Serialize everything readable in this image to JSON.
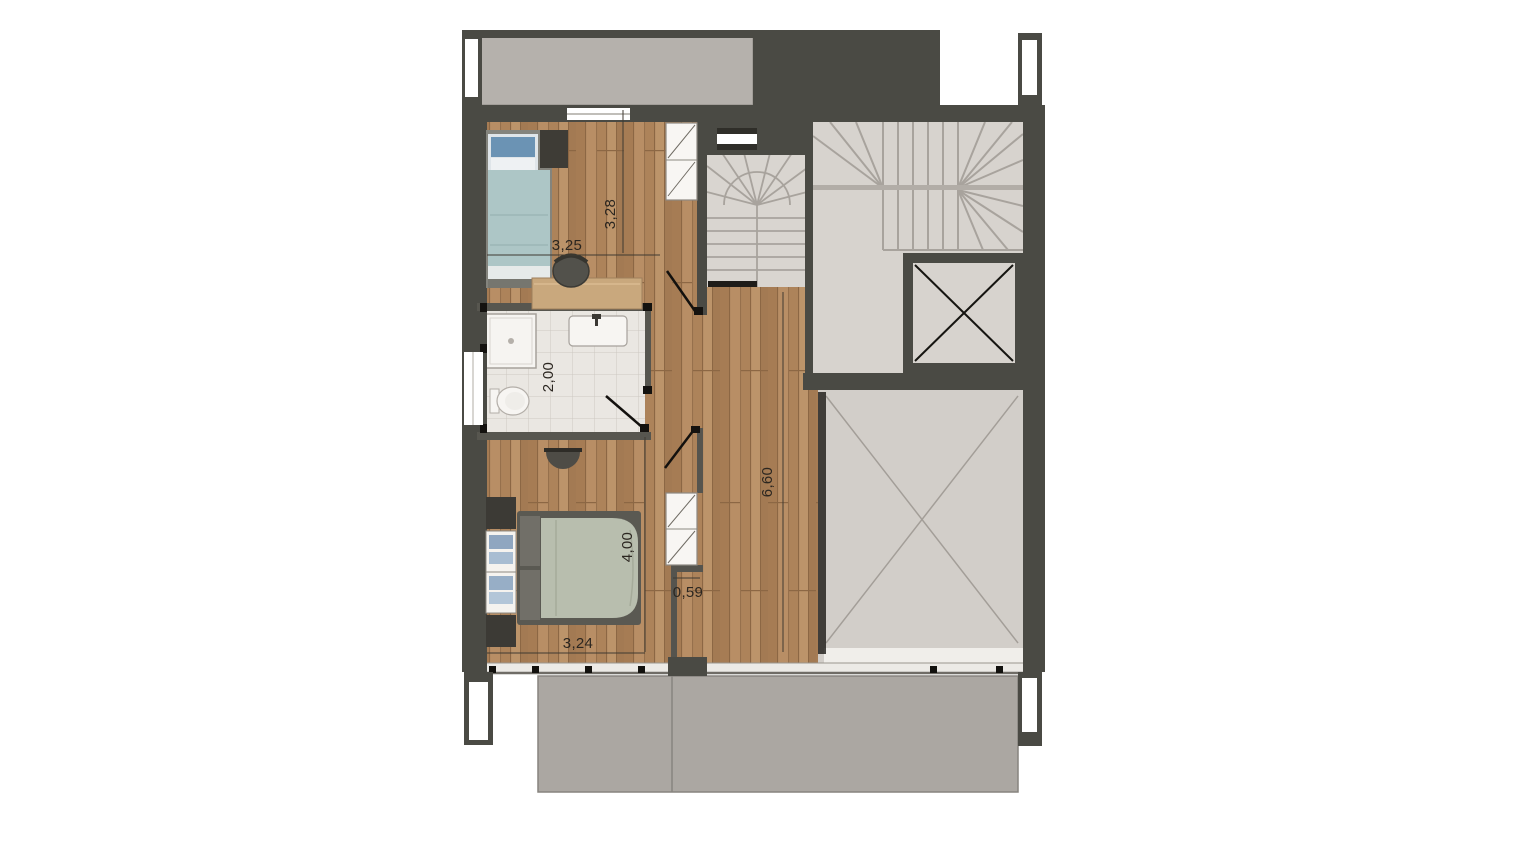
{
  "document": {
    "kind": "architectural floor plan",
    "view": "top-down furnished plan of an upper storey"
  },
  "dimensions": {
    "bedroom1_width": "3,25",
    "bedroom1_depth": "3,28",
    "bathroom_depth": "2,00",
    "hallway_length": "6,60",
    "bedroom2_depth": "4,00",
    "nook_width": "0,59",
    "bedroom2_width": "3,24"
  },
  "features": {
    "rooms": [
      "terrace-top",
      "bedroom-top",
      "winder-stair",
      "main-staircase",
      "elevator-shaft",
      "bathroom",
      "hallway",
      "bedroom-bottom",
      "void-opening",
      "terrace-bottom"
    ],
    "furniture": [
      "single-bed",
      "nightstand",
      "desk",
      "desk-chair",
      "wardrobe-top",
      "shower",
      "washbasin",
      "toilet",
      "wall-console",
      "double-bed",
      "shelf-unit",
      "wardrobe-bottom"
    ]
  },
  "colors": {
    "background": "#ffffff",
    "wall": "#4a4a44",
    "wood_floor": "#b1885f",
    "stair_floor": "#d8d4cf",
    "void_floor": "#d2cec9",
    "tile_floor": "#eae7e2",
    "terrace_top": "#b5b1ac",
    "terrace_bottom": "#aba7a2",
    "bed1_blanket": "#adc6c6",
    "bed2_blanket": "#b8beae",
    "dimension_text": "#2b2620"
  }
}
